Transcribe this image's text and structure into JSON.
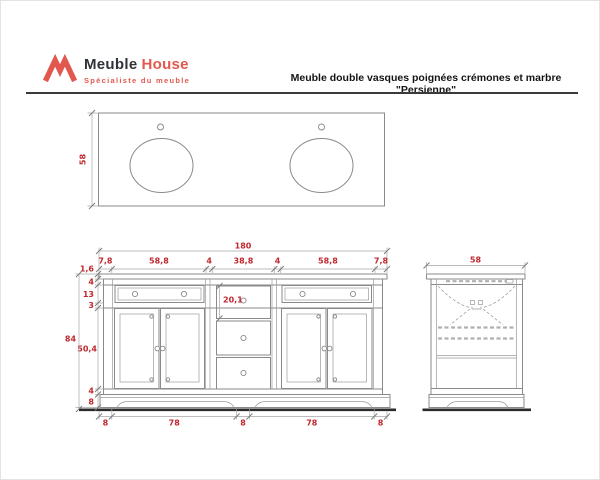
{
  "header": {
    "logo": {
      "brand_first": "Meuble",
      "brand_second": "House",
      "tagline": "Spécialiste du meuble"
    },
    "title": "Meuble double vasques poignées crémones et marbre \"Persienne\""
  },
  "colors": {
    "accent": "#e2584e",
    "dim-red": "#c1272d",
    "line": "#8a8a8a",
    "ink": "#2f3338"
  },
  "top_view": {
    "label_depth": "58"
  },
  "front_view": {
    "label_overall_width": "180",
    "top_chain": [
      "7,8",
      "58,8",
      "4",
      "38,8",
      "4",
      "58,8",
      "7,8"
    ],
    "left_chain": [
      "1,6",
      "4",
      "13",
      "3",
      "50,4",
      "4",
      "8"
    ],
    "label_overall_height": "84",
    "label_drawer_height": "20,1",
    "bottom_chain": [
      "8",
      "78",
      "8",
      "78",
      "8"
    ]
  },
  "side_view": {
    "label_depth": "58"
  }
}
